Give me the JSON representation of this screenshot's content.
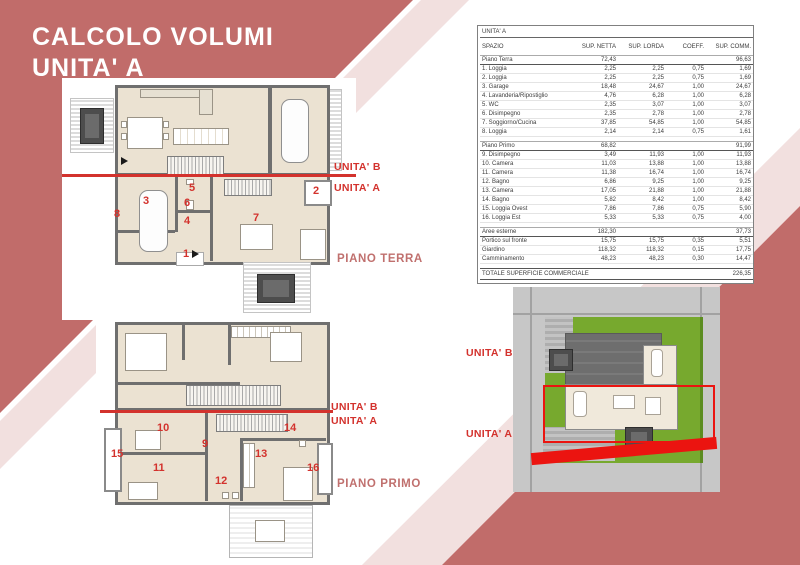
{
  "title": {
    "line1": "CALCOLO VOLUMI",
    "line2": "UNITA' A"
  },
  "labels": {
    "unit_b": "UNITA' B",
    "unit_a": "UNITA' A",
    "piano_terra": "PIANO TERRA",
    "piano_primo": "PIANO PRIMO"
  },
  "plans": {
    "terra": {
      "rooms": [
        "1",
        "2",
        "3",
        "4",
        "5",
        "6",
        "7",
        "8"
      ]
    },
    "primo": {
      "rooms": [
        "9",
        "10",
        "11",
        "12",
        "13",
        "14",
        "15",
        "16"
      ]
    }
  },
  "table": {
    "title": "UNITA' A",
    "columns": [
      "SPAZIO",
      "SUP. NETTA",
      "SUP. LORDA",
      "COEFF.",
      "SUP. COMM."
    ],
    "sections": [
      {
        "label": "Piano Terra",
        "netta": "72,43",
        "comm": "96,63",
        "rows": [
          [
            "1. Loggia",
            "2,25",
            "2,25",
            "0,75",
            "1,69"
          ],
          [
            "2. Loggia",
            "2,25",
            "2,25",
            "0,75",
            "1,69"
          ],
          [
            "3. Garage",
            "18,48",
            "24,67",
            "1,00",
            "24,67"
          ],
          [
            "4. Lavanderia/Ripostiglio",
            "4,76",
            "6,28",
            "1,00",
            "6,28"
          ],
          [
            "5. WC",
            "2,35",
            "3,07",
            "1,00",
            "3,07"
          ],
          [
            "6. Disimpegno",
            "2,35",
            "2,78",
            "1,00",
            "2,78"
          ],
          [
            "7. Soggiorno/Cucina",
            "37,85",
            "54,85",
            "1,00",
            "54,85"
          ],
          [
            "8. Loggia",
            "2,14",
            "2,14",
            "0,75",
            "1,61"
          ]
        ]
      },
      {
        "label": "Piano Primo",
        "netta": "68,82",
        "comm": "91,99",
        "rows": [
          [
            "9. Disimpegno",
            "3,49",
            "11,93",
            "1,00",
            "11,93"
          ],
          [
            "10. Camera",
            "11,03",
            "13,88",
            "1,00",
            "13,88"
          ],
          [
            "11. Camera",
            "11,38",
            "16,74",
            "1,00",
            "16,74"
          ],
          [
            "12. Bagno",
            "6,86",
            "9,25",
            "1,00",
            "9,25"
          ],
          [
            "13. Camera",
            "17,05",
            "21,88",
            "1,00",
            "21,88"
          ],
          [
            "14. Bagno",
            "5,82",
            "8,42",
            "1,00",
            "8,42"
          ],
          [
            "15. Loggia Ovest",
            "7,86",
            "7,86",
            "0,75",
            "5,90"
          ],
          [
            "16. Loggia Est",
            "5,33",
            "5,33",
            "0,75",
            "4,00"
          ]
        ]
      },
      {
        "label": "Aree esterne",
        "netta": "182,30",
        "comm": "37,73",
        "rows": [
          [
            "Portico sul fronte",
            "15,75",
            "15,75",
            "0,35",
            "5,51"
          ],
          [
            "Giardino",
            "118,32",
            "118,32",
            "0,15",
            "17,75"
          ],
          [
            "Camminamento",
            "48,23",
            "48,23",
            "0,30",
            "14,47"
          ]
        ]
      }
    ],
    "total": {
      "label": "TOTALE SUPERFICIE COMMERCIALE",
      "comm": "226,35"
    }
  },
  "colors": {
    "salmon_band": "#c16c6a",
    "pink_band": "#f2e0df",
    "accent_red": "#d3322d",
    "site_red": "#eb1410",
    "floor_beige": "#ebe2d2",
    "wall_gray": "#6f6f6f",
    "lawn_green": "#77a92e"
  }
}
